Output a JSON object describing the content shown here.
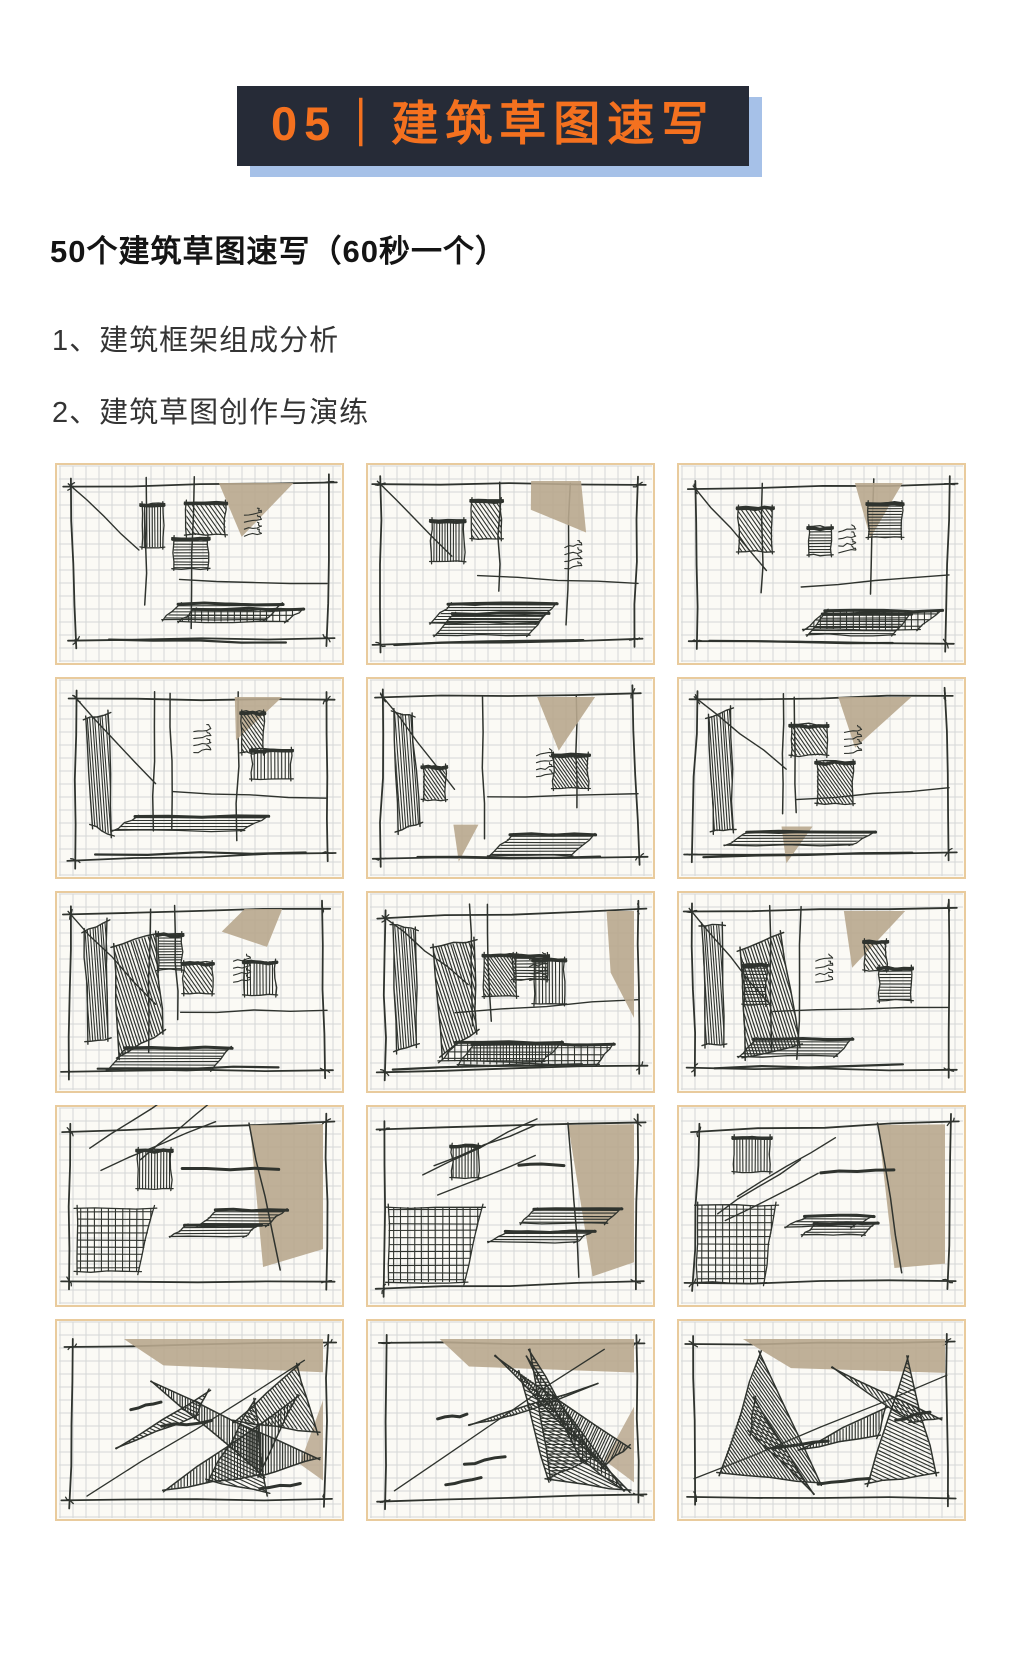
{
  "banner": {
    "title": "05｜建筑草图速写"
  },
  "intro": {
    "text": "50个建筑草图速写（60秒一个）"
  },
  "list": {
    "items": [
      "1、建筑框架组成分析",
      "2、建筑草图创作与演练"
    ]
  },
  "gallery": {
    "alt": "15 hand-drawn architectural sketch studies on grid paper, 3 columns by 5 rows",
    "panels": [
      {
        "style": "room-light",
        "seed": 101
      },
      {
        "style": "room-light",
        "seed": 2027
      },
      {
        "style": "room-light",
        "seed": 3511
      },
      {
        "style": "room-left",
        "seed": 4409
      },
      {
        "style": "room-left",
        "seed": 5521
      },
      {
        "style": "room-left",
        "seed": 6637
      },
      {
        "style": "room-dense",
        "seed": 7741
      },
      {
        "style": "room-dense",
        "seed": 8849
      },
      {
        "style": "room-dense",
        "seed": 9953
      },
      {
        "style": "axon",
        "seed": 10061
      },
      {
        "style": "axon",
        "seed": 11171
      },
      {
        "style": "axon",
        "seed": 12277
      },
      {
        "style": "chaos",
        "seed": 13381
      },
      {
        "style": "chaos",
        "seed": 14489
      },
      {
        "style": "chaos",
        "seed": 15593
      }
    ]
  },
  "colors": {
    "header_bg": "#262b37",
    "header_text": "#f4711f",
    "header_shadow": "#a6c1e8",
    "heading_text": "#141414",
    "body_text": "#343434",
    "ink": "#2f332e",
    "tan": "#b8a78e",
    "paper": "#fbfaf5",
    "grid_line": "#d5d7d6",
    "paper_border": "#e9cb9d"
  }
}
